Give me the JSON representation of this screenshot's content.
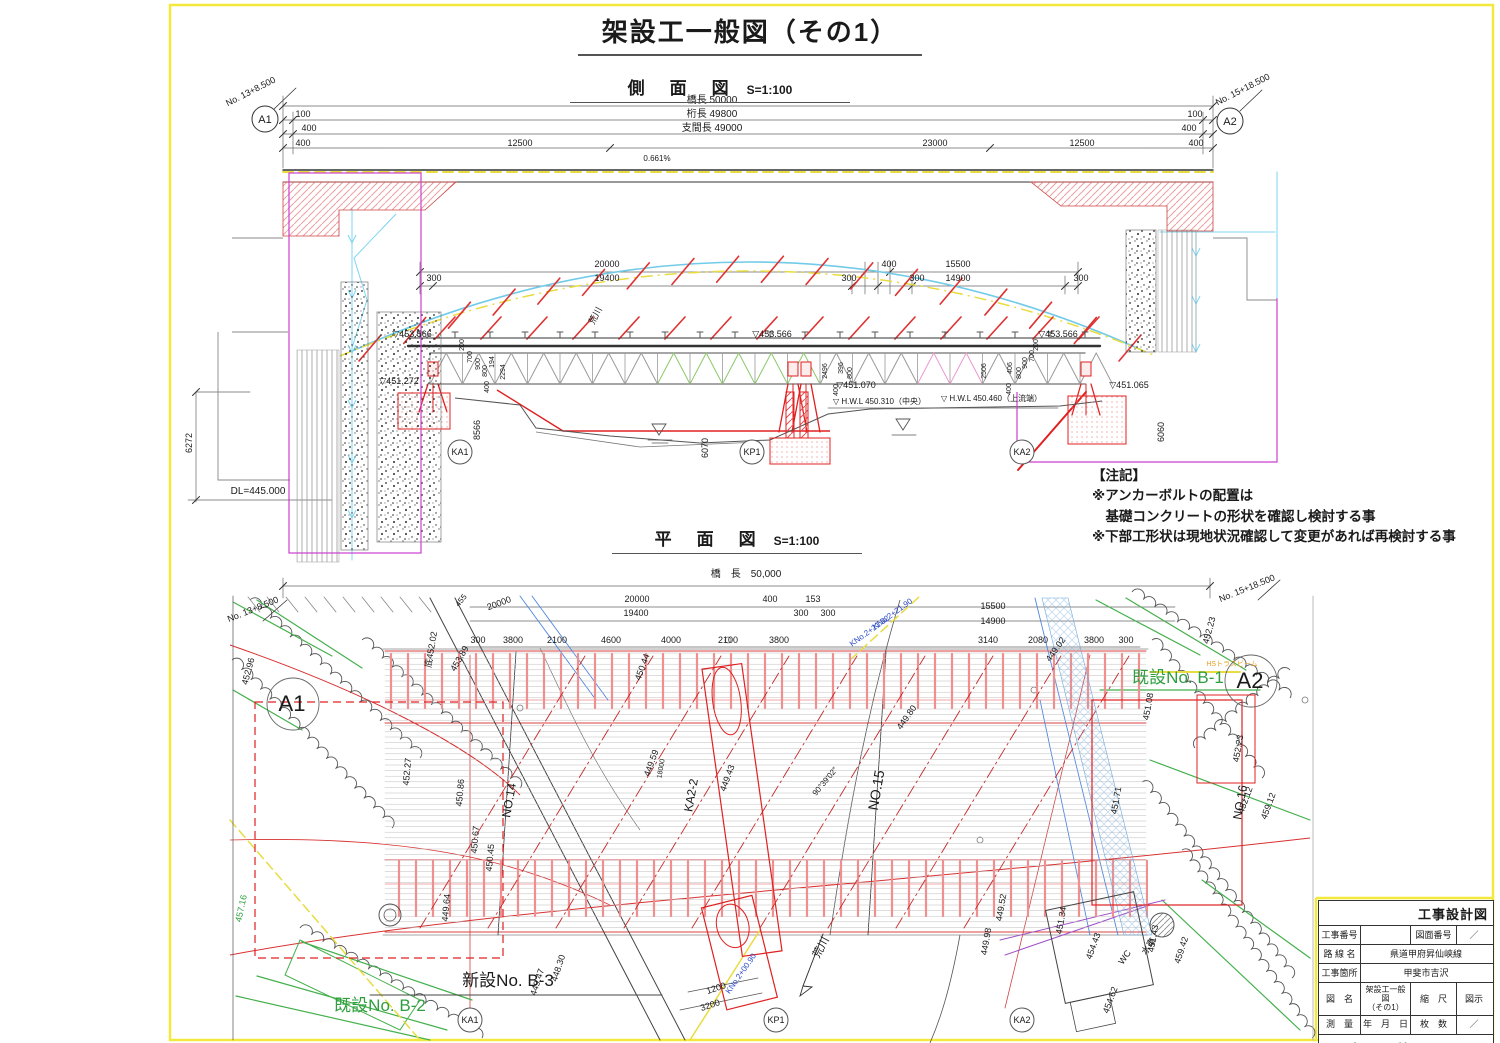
{
  "sheet": {
    "title": "架設工一般図（その1）"
  },
  "side_view": {
    "heading": "側　面　図",
    "scale": "S=1:100",
    "labels": [
      {
        "t": "No. 13+8.500",
        "x": 252,
        "y": 94,
        "r": -27
      },
      {
        "t": "A1",
        "x": 265,
        "y": 123,
        "s": 11
      },
      {
        "t": "No. 15+18.500",
        "x": 1244,
        "y": 92,
        "r": -27
      },
      {
        "t": "A2",
        "x": 1230,
        "y": 125,
        "s": 11
      },
      {
        "t": "橋長 50000",
        "x": 712,
        "y": 103,
        "s": 10
      },
      {
        "t": "100",
        "x": 303,
        "y": 117
      },
      {
        "t": "桁長 49800",
        "x": 712,
        "y": 117,
        "s": 10
      },
      {
        "t": "100",
        "x": 1195,
        "y": 117
      },
      {
        "t": "400",
        "x": 309,
        "y": 131
      },
      {
        "t": "支間長 49000",
        "x": 712,
        "y": 131,
        "s": 10
      },
      {
        "t": "400",
        "x": 1189,
        "y": 131
      },
      {
        "t": "400",
        "x": 303,
        "y": 146
      },
      {
        "t": "12500",
        "x": 520,
        "y": 146
      },
      {
        "t": "23000",
        "x": 935,
        "y": 146
      },
      {
        "t": "12500",
        "x": 1082,
        "y": 146
      },
      {
        "t": "400",
        "x": 1196,
        "y": 146
      },
      {
        "t": "0.661%",
        "x": 657,
        "y": 161,
        "s": 8
      },
      {
        "t": "20000",
        "x": 607,
        "y": 267
      },
      {
        "t": "300",
        "x": 434,
        "y": 281
      },
      {
        "t": "19400",
        "x": 607,
        "y": 281
      },
      {
        "t": "300",
        "x": 849,
        "y": 281
      },
      {
        "t": "400",
        "x": 889,
        "y": 267
      },
      {
        "t": "300",
        "x": 917,
        "y": 281
      },
      {
        "t": "15500",
        "x": 958,
        "y": 267
      },
      {
        "t": "14900",
        "x": 958,
        "y": 281
      },
      {
        "t": "300",
        "x": 1081,
        "y": 281
      },
      {
        "t": "荒川",
        "x": 598,
        "y": 317,
        "r": -62
      },
      {
        "t": "▽453.566",
        "x": 412,
        "y": 337
      },
      {
        "t": "▽453.566",
        "x": 772,
        "y": 337
      },
      {
        "t": "▽453.566",
        "x": 1058,
        "y": 337
      },
      {
        "t": "▽451.272",
        "x": 399,
        "y": 384
      },
      {
        "t": "▽451.070",
        "x": 856,
        "y": 388
      },
      {
        "t": "▽451.065",
        "x": 1129,
        "y": 388
      },
      {
        "t": "▽ H.W.L 450.310（中央）",
        "x": 833,
        "y": 404,
        "s": 8,
        "a": "start"
      },
      {
        "t": "▽ H.W.L 450.460（上流端）",
        "x": 941,
        "y": 401,
        "s": 8,
        "a": "start"
      },
      {
        "t": "DL=445.000",
        "x": 258,
        "y": 494,
        "s": 10
      },
      {
        "t": "6272",
        "x": 192,
        "y": 443,
        "r": -90
      },
      {
        "t": "8566",
        "x": 480,
        "y": 430,
        "r": -90
      },
      {
        "t": "6070",
        "x": 708,
        "y": 448,
        "r": -90
      },
      {
        "t": "6060",
        "x": 1164,
        "y": 432,
        "r": -90
      },
      {
        "t": "KA1",
        "x": 460,
        "y": 455
      },
      {
        "t": "KP1",
        "x": 752,
        "y": 455
      },
      {
        "t": "KA2",
        "x": 1022,
        "y": 455
      },
      {
        "t": "200",
        "x": 464,
        "y": 345,
        "r": -90,
        "s": 7
      },
      {
        "t": "700",
        "x": 472,
        "y": 357,
        "r": -90,
        "s": 7
      },
      {
        "t": "900",
        "x": 480,
        "y": 364,
        "r": -90,
        "s": 7
      },
      {
        "t": "800",
        "x": 487,
        "y": 371,
        "r": -90,
        "s": 7
      },
      {
        "t": "194",
        "x": 494,
        "y": 362,
        "r": -90,
        "s": 7
      },
      {
        "t": "400",
        "x": 489,
        "y": 387,
        "r": -90,
        "s": 7
      },
      {
        "t": "2294",
        "x": 505,
        "y": 372,
        "r": -90,
        "s": 7
      },
      {
        "t": "2496",
        "x": 827,
        "y": 371,
        "r": -90,
        "s": 7
      },
      {
        "t": "396",
        "x": 843,
        "y": 368,
        "r": -90,
        "s": 7
      },
      {
        "t": "800",
        "x": 852,
        "y": 373,
        "r": -90,
        "s": 7
      },
      {
        "t": "400",
        "x": 838,
        "y": 390,
        "r": -90,
        "s": 7
      },
      {
        "t": "2506",
        "x": 986,
        "y": 371,
        "r": -90,
        "s": 7
      },
      {
        "t": "406",
        "x": 1012,
        "y": 368,
        "r": -90,
        "s": 7
      },
      {
        "t": "400",
        "x": 1011,
        "y": 389,
        "r": -90,
        "s": 7
      },
      {
        "t": "800",
        "x": 1021,
        "y": 373,
        "r": -90,
        "s": 7
      },
      {
        "t": "900",
        "x": 1027,
        "y": 363,
        "r": -90,
        "s": 7
      },
      {
        "t": "700",
        "x": 1034,
        "y": 356,
        "r": -90,
        "s": 7
      },
      {
        "t": "200",
        "x": 1038,
        "y": 345,
        "r": -90,
        "s": 7
      }
    ]
  },
  "plan_view": {
    "heading": "平　面　図",
    "scale": "S=1:100",
    "labels": [
      {
        "t": "橋　長　50,000",
        "x": 746,
        "y": 577,
        "s": 10
      },
      {
        "t": "No. 13+8.500",
        "x": 254,
        "y": 612,
        "r": -22
      },
      {
        "t": "No. 15+18.500",
        "x": 1248,
        "y": 591,
        "r": -22
      },
      {
        "t": "20000",
        "x": 637,
        "y": 602
      },
      {
        "t": "400",
        "x": 770,
        "y": 602
      },
      {
        "t": "153",
        "x": 813,
        "y": 602
      },
      {
        "t": "15500",
        "x": 993,
        "y": 609
      },
      {
        "t": "19400",
        "x": 636,
        "y": 616
      },
      {
        "t": "300",
        "x": 801,
        "y": 616
      },
      {
        "t": "300",
        "x": 828,
        "y": 616
      },
      {
        "t": "14900",
        "x": 993,
        "y": 624
      },
      {
        "t": "300",
        "x": 478,
        "y": 643
      },
      {
        "t": "3800",
        "x": 513,
        "y": 643
      },
      {
        "t": "2100",
        "x": 557,
        "y": 643
      },
      {
        "t": "4600",
        "x": 611,
        "y": 643
      },
      {
        "t": "4000",
        "x": 671,
        "y": 643
      },
      {
        "t": "2100",
        "x": 728,
        "y": 643
      },
      {
        "t": "3800",
        "x": 779,
        "y": 643
      },
      {
        "t": "3140",
        "x": 988,
        "y": 643
      },
      {
        "t": "2080",
        "x": 1038,
        "y": 643
      },
      {
        "t": "3800",
        "x": 1094,
        "y": 643
      },
      {
        "t": "300",
        "x": 1126,
        "y": 643
      },
      {
        "t": "20000",
        "x": 500,
        "y": 606,
        "r": -20
      },
      {
        "t": "455",
        "x": 463,
        "y": 602,
        "r": -50,
        "s": 8
      },
      {
        "t": "A1",
        "x": 292,
        "y": 711,
        "s": 22
      },
      {
        "t": "A2",
        "x": 1250,
        "y": 688,
        "s": 22
      },
      {
        "t": "底452.02",
        "x": 434,
        "y": 650,
        "r": -80
      },
      {
        "t": "452.96",
        "x": 251,
        "y": 672,
        "r": -75
      },
      {
        "t": "452.23",
        "x": 1212,
        "y": 631,
        "r": -75
      },
      {
        "t": "450.44",
        "x": 645,
        "y": 668,
        "r": -70
      },
      {
        "t": "453.89",
        "x": 462,
        "y": 660,
        "r": -60
      },
      {
        "t": "452.27",
        "x": 410,
        "y": 772,
        "r": -85
      },
      {
        "t": "450.86",
        "x": 463,
        "y": 793,
        "r": -85
      },
      {
        "t": "450.67",
        "x": 478,
        "y": 840,
        "r": -85
      },
      {
        "t": "450.45",
        "x": 493,
        "y": 858,
        "r": -85
      },
      {
        "t": "449.64",
        "x": 449,
        "y": 908,
        "r": -85
      },
      {
        "t": "449.47",
        "x": 540,
        "y": 983,
        "r": -72
      },
      {
        "t": "448.30",
        "x": 561,
        "y": 969,
        "r": -72
      },
      {
        "t": "新設No. B-3",
        "x": 508,
        "y": 986,
        "s": 17
      },
      {
        "t": "既設No. B-2",
        "x": 380,
        "y": 1011,
        "s": 17,
        "c": "g"
      },
      {
        "t": "既設No. B-1",
        "x": 1178,
        "y": 683,
        "s": 17,
        "c": "g"
      },
      {
        "t": "HSトラスビーム",
        "x": 1232,
        "y": 666,
        "s": 7,
        "c": "o"
      },
      {
        "t": "KA2-2",
        "x": 695,
        "y": 796,
        "r": -80,
        "s": 12
      },
      {
        "t": "NO.14",
        "x": 513,
        "y": 801,
        "r": -80,
        "s": 12
      },
      {
        "t": "NO.15",
        "x": 881,
        "y": 791,
        "r": -80,
        "s": 14
      },
      {
        "t": "NO.16",
        "x": 1244,
        "y": 803,
        "r": -80,
        "s": 12
      },
      {
        "t": "荒川",
        "x": 824,
        "y": 949,
        "r": -62,
        "s": 11
      },
      {
        "t": "WC",
        "x": 1127,
        "y": 959,
        "r": -55
      },
      {
        "t": "水車",
        "x": 1151,
        "y": 948,
        "r": -55
      },
      {
        "t": "459.42",
        "x": 1184,
        "y": 951,
        "r": -72
      },
      {
        "t": "454.43",
        "x": 1096,
        "y": 947,
        "r": -70
      },
      {
        "t": "454.62",
        "x": 1113,
        "y": 1001,
        "r": -70
      },
      {
        "t": "451.34",
        "x": 1064,
        "y": 921,
        "r": -80
      },
      {
        "t": "449.52",
        "x": 1004,
        "y": 908,
        "r": -80
      },
      {
        "t": "449.98",
        "x": 989,
        "y": 942,
        "r": -80
      },
      {
        "t": "451.43",
        "x": 1156,
        "y": 939,
        "r": -80
      },
      {
        "t": "451.71",
        "x": 1119,
        "y": 801,
        "r": -80
      },
      {
        "t": "451.08",
        "x": 1151,
        "y": 707,
        "r": -80
      },
      {
        "t": "449.02",
        "x": 1058,
        "y": 651,
        "r": -55
      },
      {
        "t": "449.80",
        "x": 909,
        "y": 719,
        "r": -55
      },
      {
        "t": "449.59",
        "x": 654,
        "y": 764,
        "r": -70
      },
      {
        "t": "449.43",
        "x": 730,
        "y": 779,
        "r": -70
      },
      {
        "t": "18000",
        "x": 663,
        "y": 769,
        "r": -80,
        "s": 7
      },
      {
        "t": "452.23",
        "x": 1241,
        "y": 749,
        "r": -80
      },
      {
        "t": "452.12",
        "x": 1248,
        "y": 801,
        "r": -70
      },
      {
        "t": "459.12",
        "x": 1271,
        "y": 807,
        "r": -70
      },
      {
        "t": "457.16",
        "x": 244,
        "y": 909,
        "r": -78,
        "c": "g"
      },
      {
        "t": "KNo.2+21.90",
        "x": 894,
        "y": 616,
        "r": -36,
        "s": 8,
        "c": "b"
      },
      {
        "t": "KNo.2+21.02",
        "x": 871,
        "y": 633,
        "r": -36,
        "s": 8,
        "c": "b"
      },
      {
        "t": "KNo.2+00.90",
        "x": 743,
        "y": 975,
        "r": -55,
        "s": 8,
        "c": "b"
      },
      {
        "t": "90°39′02″",
        "x": 827,
        "y": 783,
        "r": -50,
        "s": 8
      },
      {
        "t": "1200",
        "x": 717,
        "y": 991,
        "r": -18
      },
      {
        "t": "3200",
        "x": 711,
        "y": 1008,
        "r": -18
      },
      {
        "t": "KA1",
        "x": 470,
        "y": 1023
      },
      {
        "t": "KP1",
        "x": 776,
        "y": 1023
      },
      {
        "t": "KA2",
        "x": 1022,
        "y": 1023
      }
    ]
  },
  "notes": {
    "header": "【注記】",
    "lines": [
      "※アンカーボルトの配置は",
      "　基礎コンクリートの形状を確認し検討する事",
      "※下部工形状は現地状況確認して変更があれば再検討する事"
    ]
  },
  "title_block": {
    "header": "工事設計図",
    "fields": {
      "construction_no_label": "工事番号",
      "construction_no": "",
      "drawing_no_label": "図面番号",
      "drawing_no": "／",
      "route_label": "路 線 名",
      "route": "県道甲府昇仙峡線",
      "location_label": "工事箇所",
      "location": "甲斐市吉沢",
      "drawing_name_label": "図　名",
      "drawing_name": "架設工一般図\n（その1）",
      "scale_label": "縮　尺",
      "scale": "図示",
      "survey_label": "測　量",
      "survey_date": "年　月　日",
      "sheets_label": "枚　数",
      "sheets": "／",
      "prefecture": "山　梨　県"
    }
  }
}
